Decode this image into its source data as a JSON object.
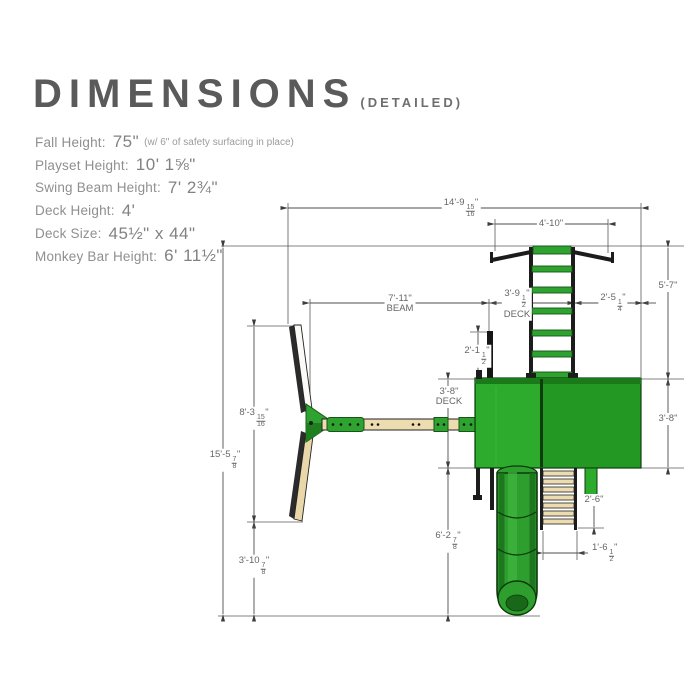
{
  "title": {
    "main": "DIMENSIONS",
    "sub": "(DETAILED)"
  },
  "specs": [
    {
      "label": "Fall Height:",
      "value": "75\"",
      "note": "(w/ 6\" of safety surfacing in place)"
    },
    {
      "label": "Playset Height:",
      "value": "10' 1⅝\"",
      "note": ""
    },
    {
      "label": "Swing Beam Height:",
      "value": "7' 2¾\"",
      "note": ""
    },
    {
      "label": "Deck Height:",
      "value": "4'",
      "note": ""
    },
    {
      "label": "Deck Size:",
      "value": "45½\" x 44\"",
      "note": ""
    },
    {
      "label": "Monkey Bar Height:",
      "value": "6' 11½\"",
      "note": ""
    }
  ],
  "dims": {
    "overall_width": {
      "pre": "14'-9",
      "num": "15",
      "den": "16",
      "suf": "\""
    },
    "monkey_bar_width": {
      "text": "4'-10\""
    },
    "beam_length": {
      "text": "7'-11\"",
      "sub": "BEAM"
    },
    "deck_width_top": {
      "pre": "3'-9",
      "num": "1",
      "den": "2",
      "suf": "\"",
      "sub": "DECK"
    },
    "edge_offset_right": {
      "pre": "2'-5",
      "num": "1",
      "den": "4",
      "suf": "\""
    },
    "monkey_bar_to_edge": {
      "text": "5'-7\""
    },
    "deck_depth_right": {
      "text": "3'-8\""
    },
    "post_offset": {
      "pre": "2'-1",
      "num": "1",
      "den": "2",
      "suf": "\""
    },
    "deck_depth_left": {
      "text": "3'-8\"",
      "sub": "DECK"
    },
    "aframe_span": {
      "pre": "8'-3",
      "num": "15",
      "den": "16",
      "suf": "\""
    },
    "total_depth": {
      "pre": "15'-5",
      "num": "7",
      "den": "8",
      "suf": "\""
    },
    "deck_to_edge": {
      "pre": "6'-2",
      "num": "7",
      "den": "8",
      "suf": "\""
    },
    "leg_to_edge": {
      "pre": "3'-10",
      "num": "7",
      "den": "8",
      "suf": "\""
    },
    "ladder_depth": {
      "text": "2'-6\""
    },
    "ladder_width": {
      "pre": "1'-6",
      "num": "1",
      "den": "2",
      "suf": "\""
    }
  }
}
